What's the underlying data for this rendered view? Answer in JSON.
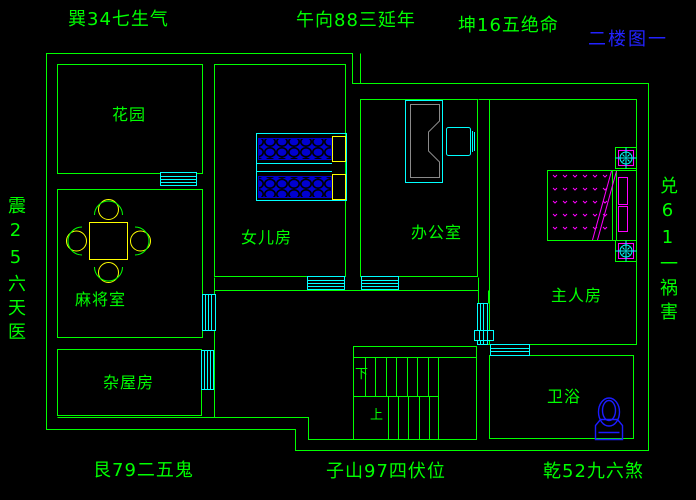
{
  "drawing_title": "二楼图一",
  "feng_shui_labels": {
    "top_left": "巽34七生气",
    "top_center": "午向88三延年",
    "top_right": "坤16五绝命",
    "left": "震25六天医",
    "right": "兑61一祸害",
    "bottom_left": "艮79二五鬼",
    "bottom_center": "子山97四伏位",
    "bottom_right": "乾52九六煞"
  },
  "rooms": {
    "garden": "花园",
    "daughter_room": "女儿房",
    "office": "办公室",
    "mahjong_room": "麻将室",
    "master_room": "主人房",
    "storage_room": "杂屋房",
    "bathroom": "卫浴"
  },
  "stairs": {
    "down_label": "下",
    "up_label": "上"
  },
  "colors": {
    "background": "#000000",
    "walls_and_text": "#00ff00",
    "windows_and_fixtures": "#00ffff",
    "beds_and_toilet": "#1c1cff",
    "pillows_and_table": "#ffff00",
    "master_bed_accents": "#ff00ff",
    "title_text": "#2222ff",
    "desk_outline": "#8a8a8a"
  }
}
